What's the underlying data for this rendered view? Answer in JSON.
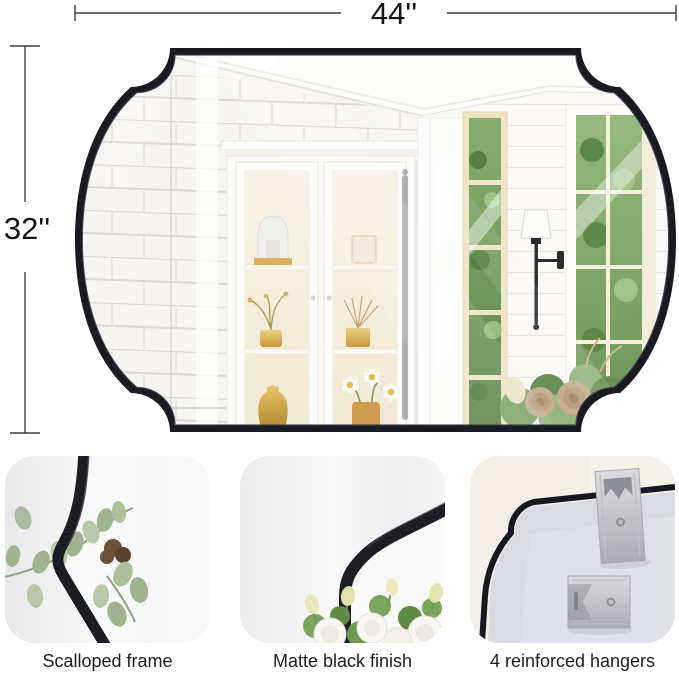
{
  "page": {
    "background": "#ffffff"
  },
  "dimensions": {
    "width_label": "44''",
    "height_label": "32''"
  },
  "product": {
    "type": "scalloped wall mirror",
    "frame_finish": "matte black",
    "frame_color": "#1a1a23"
  },
  "thumbnails": [
    {
      "id": "scalloped-frame",
      "caption": "Scalloped frame"
    },
    {
      "id": "matte-black-finish",
      "caption": "Matte black finish"
    },
    {
      "id": "reinforced-hangers",
      "caption": "4 reinforced hangers"
    }
  ],
  "colors": {
    "dimension_line": "#3c3c3c",
    "caption_text": "#1d1d1d",
    "mirror_frame": "#1a1a23",
    "hanger_metal": "#c2c2c8",
    "back_board": "#dadae4"
  }
}
